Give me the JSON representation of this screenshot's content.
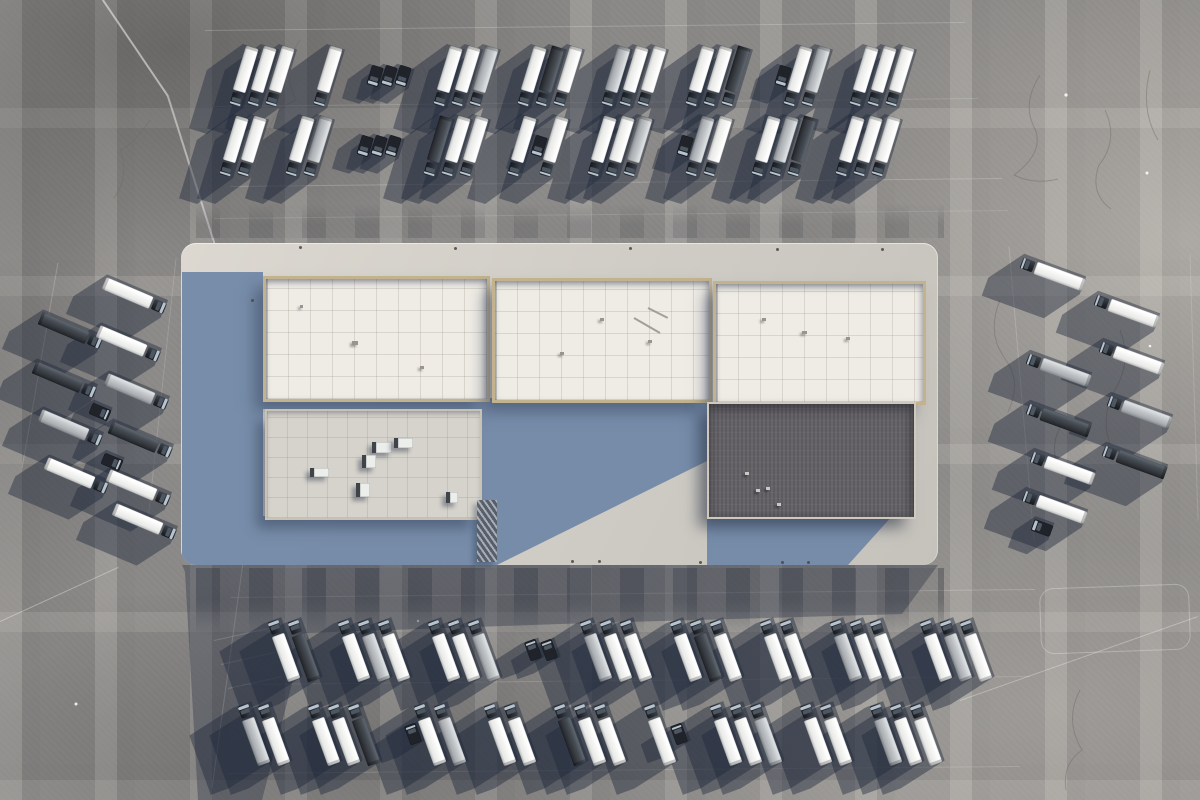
{
  "scene": {
    "subject": "aerial view of a warehouse logistics center with parked semi-truck fleet",
    "canvas": {
      "w": 1200,
      "h": 800
    },
    "palette": {
      "pavement": "#8b8987",
      "pavement_dark": "#6f6e6c",
      "pavement_light": "#aaa7a2",
      "platform_lit": "#d8d5ce",
      "platform_shade_blue": "#7289a8",
      "roof_white": "#efece5",
      "roof_frame_tan": "#c2b28e",
      "roof_gray": "#d6d3cc",
      "roof_dark": "#67656a",
      "trailer_white": "#f4f5f3",
      "trailer_silver": "#c2c6c9",
      "trailer_dark": "#34383e",
      "cab_dark": "#262b31",
      "windshield": "#b7c3ce",
      "vehicle_shadow": "rgba(31,39,57,0.43)",
      "ground_shadow": "rgba(38,47,66,0.37)"
    },
    "markings": {
      "lines": [
        {
          "x1": 103,
          "y1": 0,
          "x2": 168,
          "y2": 96,
          "w": 1.5,
          "o": 0.5
        },
        {
          "x1": 168,
          "y1": 96,
          "x2": 216,
          "y2": 248,
          "w": 1.5,
          "o": 0.45
        },
        {
          "x1": 205,
          "y1": 30,
          "x2": 965,
          "y2": 22,
          "w": 1,
          "o": 0.2
        },
        {
          "x1": 214,
          "y1": 106,
          "x2": 978,
          "y2": 98,
          "w": 1,
          "o": 0.15
        },
        {
          "x1": 230,
          "y1": 186,
          "x2": 1002,
          "y2": 178,
          "w": 1,
          "o": 0.2
        },
        {
          "x1": 214,
          "y1": 218,
          "x2": 1008,
          "y2": 210,
          "w": 1,
          "o": 0.12
        },
        {
          "x1": 230,
          "y1": 597,
          "x2": 1035,
          "y2": 589,
          "w": 1,
          "o": 0.2
        },
        {
          "x1": 243,
          "y1": 684,
          "x2": 1030,
          "y2": 676,
          "w": 1,
          "o": 0.15
        },
        {
          "x1": 228,
          "y1": 773,
          "x2": 1020,
          "y2": 766,
          "w": 1,
          "o": 0.16
        },
        {
          "x1": 0,
          "y1": 622,
          "x2": 118,
          "y2": 568,
          "w": 1.2,
          "o": 0.35
        },
        {
          "x1": 243,
          "y1": 562,
          "x2": 212,
          "y2": 788,
          "w": 1.2,
          "o": 0.3
        },
        {
          "x1": 960,
          "y1": 700,
          "x2": 1198,
          "y2": 616,
          "w": 1,
          "o": 0.3
        },
        {
          "x1": 58,
          "y1": 262,
          "x2": 22,
          "y2": 468,
          "w": 1,
          "o": 0.2
        },
        {
          "x1": 176,
          "y1": 258,
          "x2": 148,
          "y2": 520,
          "w": 1,
          "o": 0.15
        },
        {
          "x1": 1009,
          "y1": 246,
          "x2": 1034,
          "y2": 540,
          "w": 1,
          "o": 0.18
        },
        {
          "x1": 1190,
          "y1": 254,
          "x2": 1198,
          "y2": 520,
          "w": 1,
          "o": 0.15
        },
        {
          "x1": 214,
          "y1": 640,
          "x2": 268,
          "y2": 628,
          "w": 1,
          "o": 0.3
        },
        {
          "x1": 221,
          "y1": 664,
          "x2": 275,
          "y2": 652,
          "w": 1,
          "o": 0.3
        },
        {
          "x1": 228,
          "y1": 688,
          "x2": 282,
          "y2": 676,
          "w": 1,
          "o": 0.3
        }
      ],
      "rounded_outline": {
        "x": 1040,
        "y": 586,
        "w": 148,
        "h": 64,
        "r": 14,
        "rot": -2,
        "o": 0.5
      }
    },
    "building": {
      "platform": {
        "x": 181,
        "y": 243,
        "w": 757,
        "h": 322,
        "r": 15
      },
      "shade_polys": [
        [
          [
            182,
            272
          ],
          [
            263,
            272
          ],
          [
            263,
            565
          ],
          [
            182,
            565
          ]
        ],
        [
          [
            263,
            396
          ],
          [
            478,
            396
          ],
          [
            478,
            409
          ],
          [
            263,
            409
          ]
        ],
        [
          [
            263,
            516
          ],
          [
            478,
            516
          ],
          [
            478,
            565
          ],
          [
            263,
            565
          ]
        ],
        [
          [
            478,
            398
          ],
          [
            707,
            398
          ],
          [
            707,
            461
          ],
          [
            497,
            565
          ],
          [
            478,
            565
          ]
        ],
        [
          [
            707,
            515
          ],
          [
            893,
            515
          ],
          [
            848,
            565
          ],
          [
            707,
            565
          ]
        ]
      ],
      "ground_shadow": [
        [
          182,
          565
        ],
        [
          938,
          565
        ],
        [
          902,
          614
        ],
        [
          560,
          624
        ],
        [
          305,
          633
        ],
        [
          262,
          800
        ],
        [
          198,
          800
        ],
        [
          185,
          572
        ]
      ],
      "dock_bands": [
        {
          "x": 196,
          "y": 568,
          "w": 748,
          "h": 70,
          "kind": "bottom"
        },
        {
          "x": 196,
          "y": 204,
          "w": 748,
          "h": 34,
          "kind": "top"
        }
      ],
      "roofs": [
        {
          "name": "roof-section-a",
          "x": 263,
          "y": 276,
          "w": 221,
          "h": 120,
          "kind": "tileWhite"
        },
        {
          "name": "roof-section-b",
          "x": 492,
          "y": 278,
          "w": 214,
          "h": 119,
          "kind": "tileWhite"
        },
        {
          "name": "roof-section-c",
          "x": 713,
          "y": 281,
          "w": 207,
          "h": 118,
          "kind": "tileWhite"
        },
        {
          "name": "roof-section-d",
          "x": 265,
          "y": 409,
          "w": 213,
          "h": 107,
          "kind": "tileGray"
        },
        {
          "name": "roof-section-dark",
          "x": 707,
          "y": 402,
          "w": 205,
          "h": 113,
          "kind": "dark"
        }
      ],
      "rooftop_units": [
        {
          "x": 372,
          "y": 442,
          "w": 16,
          "h": 11
        },
        {
          "x": 394,
          "y": 438,
          "w": 15,
          "h": 10
        },
        {
          "x": 362,
          "y": 455,
          "w": 10,
          "h": 13
        },
        {
          "x": 310,
          "y": 468,
          "w": 15,
          "h": 9
        },
        {
          "x": 356,
          "y": 483,
          "w": 10,
          "h": 14
        },
        {
          "x": 446,
          "y": 492,
          "w": 8,
          "h": 11
        }
      ],
      "roof_marks": [
        {
          "x": 352,
          "y": 341,
          "w": 6,
          "h": 4,
          "t": "dk"
        },
        {
          "x": 420,
          "y": 366,
          "w": 4,
          "h": 3,
          "t": "dk"
        },
        {
          "x": 300,
          "y": 305,
          "w": 3,
          "h": 3,
          "t": "dk"
        },
        {
          "x": 600,
          "y": 318,
          "w": 4,
          "h": 3,
          "t": "dk"
        },
        {
          "x": 560,
          "y": 352,
          "w": 4,
          "h": 3,
          "t": "dk"
        },
        {
          "x": 648,
          "y": 340,
          "w": 4,
          "h": 3,
          "t": "dk"
        },
        {
          "x": 762,
          "y": 318,
          "w": 4,
          "h": 3,
          "t": "dk"
        },
        {
          "x": 802,
          "y": 331,
          "w": 5,
          "h": 3,
          "t": "dk"
        },
        {
          "x": 846,
          "y": 337,
          "w": 4,
          "h": 3,
          "t": "dk"
        },
        {
          "x": 745,
          "y": 472,
          "w": 4,
          "h": 3,
          "t": "lt"
        },
        {
          "x": 756,
          "y": 489,
          "w": 4,
          "h": 3,
          "t": "lt"
        },
        {
          "x": 766,
          "y": 487,
          "w": 4,
          "h": 3,
          "t": "lt"
        },
        {
          "x": 777,
          "y": 503,
          "w": 4,
          "h": 3,
          "t": "lt"
        }
      ],
      "roof_pipes": [
        {
          "x1": 634,
          "y1": 318,
          "x2": 660,
          "y2": 333,
          "w": 2,
          "o": 0.8,
          "c": "#8f8c86"
        },
        {
          "x1": 648,
          "y1": 308,
          "x2": 668,
          "y2": 318,
          "w": 2,
          "o": 0.8,
          "c": "#8f8c86"
        }
      ],
      "truss_strip": {
        "x": 477,
        "y": 500,
        "w": 20,
        "h": 62
      },
      "edge_bolts": [
        [
          300,
          247
        ],
        [
          455,
          248
        ],
        [
          630,
          248
        ],
        [
          777,
          249
        ],
        [
          882,
          249
        ],
        [
          252,
          300
        ],
        [
          572,
          561
        ],
        [
          599,
          561
        ],
        [
          700,
          562
        ],
        [
          782,
          562
        ],
        [
          808,
          562
        ]
      ]
    },
    "vehicles": {
      "shadow_color": "rgba(31,39,57,0.43)",
      "groups": [
        {
          "name": "north-row-1",
          "angle": 17,
          "cab_end": "bottom",
          "len": 61,
          "y": 76,
          "x_start": 243,
          "pitch": 18,
          "gap": 30,
          "shadow": [
            -36,
            26
          ],
          "items": [
            "white",
            "white",
            "white",
            "gap",
            "white",
            "gap",
            "tractor",
            "tractor",
            "tractor",
            "gap",
            "white",
            "white",
            "silver",
            "gap",
            "white",
            "dark",
            "white",
            "gap",
            "silver",
            "white",
            "white",
            "gap",
            "white",
            "white",
            "dark",
            "gap",
            "tractor",
            "white",
            "silver",
            "gap",
            "white",
            "white",
            "white"
          ]
        },
        {
          "name": "north-row-2",
          "angle": 17,
          "cab_end": "bottom",
          "len": 61,
          "y": 146,
          "x_start": 233,
          "pitch": 18,
          "gap": 30,
          "shadow": [
            -36,
            26
          ],
          "items": [
            "white",
            "white",
            "gap",
            "white",
            "silver",
            "gap",
            "tractor",
            "tractor",
            "tractor",
            "gap",
            "dark",
            "white",
            "white",
            "gap",
            "white",
            "tractor",
            "white",
            "gap",
            "white",
            "white",
            "silver",
            "gap",
            "tractor",
            "silver",
            "white",
            "gap",
            "white",
            "silver",
            "dark",
            "gap",
            "white",
            "white",
            "white"
          ]
        },
        {
          "name": "south-row-1",
          "angle": -20,
          "cab_end": "top",
          "len": 63,
          "y": 650,
          "x_start": 283,
          "pitch": 20,
          "gap": 30,
          "shadow": [
            -44,
            28
          ],
          "items": [
            "white",
            "dark",
            "gap",
            "white",
            "silver",
            "white",
            "gap",
            "white",
            "white",
            "silver",
            "gap",
            "tractor",
            "tractor",
            "gap",
            "silver",
            "white",
            "white",
            "gap",
            "white",
            "dark",
            "white",
            "gap",
            "white",
            "white",
            "gap",
            "silver",
            "white",
            "white",
            "gap",
            "white",
            "silver",
            "white"
          ]
        },
        {
          "name": "south-row-2",
          "angle": -20,
          "cab_end": "top",
          "len": 63,
          "y": 734,
          "x_start": 253,
          "pitch": 20,
          "gap": 30,
          "shadow": [
            -44,
            28
          ],
          "items": [
            "silver",
            "white",
            "gap",
            "white",
            "white",
            "dark",
            "gap",
            "tractor",
            "white",
            "silver",
            "gap",
            "white",
            "white",
            "gap",
            "dark",
            "white",
            "white",
            "gap",
            "white",
            "tractor",
            "gap",
            "white",
            "white",
            "silver",
            "gap",
            "white",
            "white",
            "gap",
            "silver",
            "white",
            "white"
          ]
        },
        {
          "name": "west-cluster",
          "angle": 113,
          "cab_end": "top",
          "len": 66,
          "shadow": [
            -34,
            22
          ],
          "positions": [
            [
              134,
              296,
              "white"
            ],
            [
              70,
              331,
              "dark"
            ],
            [
              128,
              344,
              "white"
            ],
            [
              64,
              380,
              "dark"
            ],
            [
              136,
              392,
              "silver"
            ],
            [
              100,
              412,
              "tractor"
            ],
            [
              70,
              428,
              "silver"
            ],
            [
              140,
              440,
              "dark"
            ],
            [
              112,
              462,
              "tractor"
            ],
            [
              76,
              476,
              "white"
            ],
            [
              138,
              488,
              "white"
            ],
            [
              144,
              522,
              "white"
            ]
          ]
        },
        {
          "name": "east-cluster",
          "angle": 110,
          "cab_end": "bottom",
          "len": 66,
          "shadow": [
            -36,
            24
          ],
          "positions": [
            [
              1052,
              274,
              "white"
            ],
            [
              1126,
              311,
              "white"
            ],
            [
              1058,
              370,
              "silver"
            ],
            [
              1131,
              358,
              "white"
            ],
            [
              1139,
              412,
              "silver"
            ],
            [
              1058,
              420,
              "dark"
            ],
            [
              1062,
              468,
              "white"
            ],
            [
              1134,
              462,
              "dark"
            ],
            [
              1054,
              507,
              "white"
            ],
            [
              1042,
              528,
              "tractor"
            ]
          ]
        }
      ]
    }
  }
}
